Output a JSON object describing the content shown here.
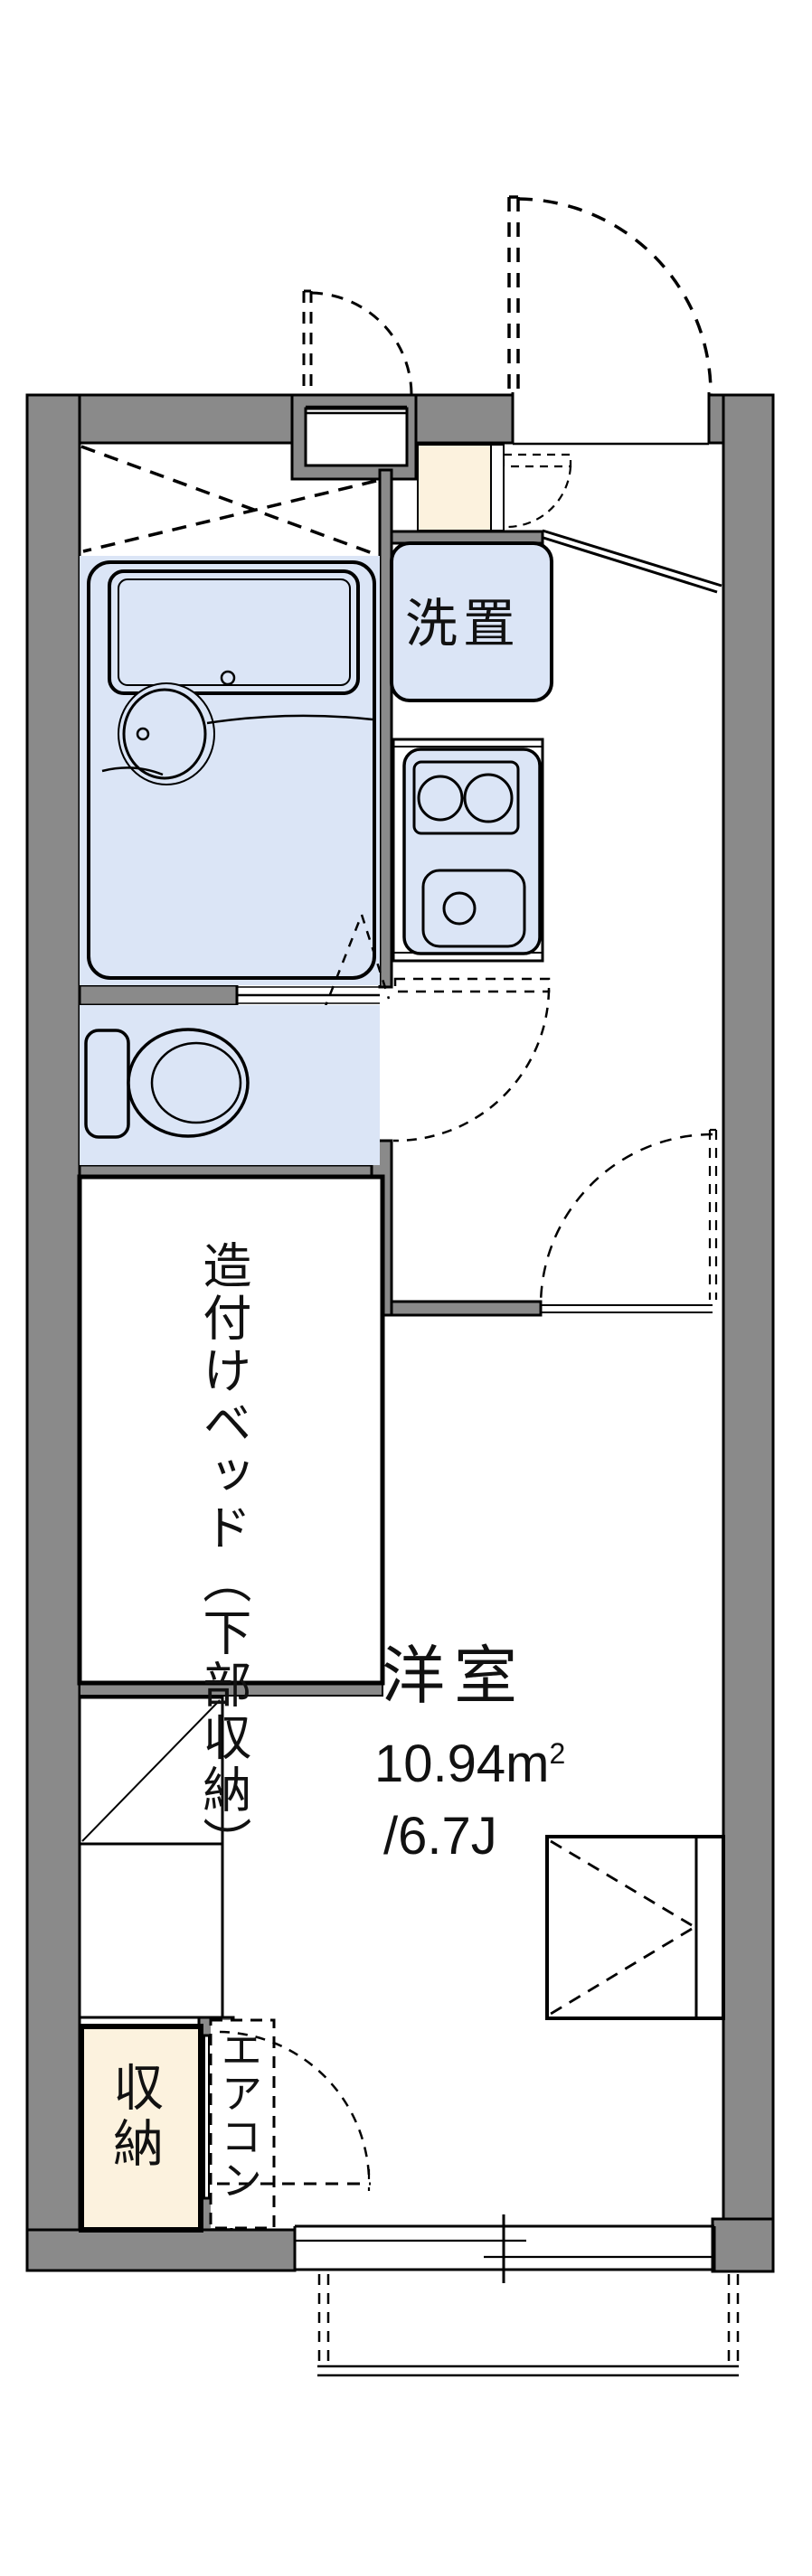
{
  "title": "1K apartment floor plan",
  "colors": {
    "wall": "#8a8a8a",
    "black": "#000000",
    "water": "#dbe5f6",
    "cream": "#fcf2de",
    "white": "#ffffff"
  },
  "labels": {
    "laundry": "洗置",
    "built_in_bed": "造付けベッド（下部収納）",
    "room_name": "洋室",
    "room_area": "10.94m",
    "room_area_sup": "2",
    "room_size": "/6.7J",
    "closet": "収納",
    "aircon": "エアコン"
  },
  "room_values": {
    "western_room_sqm": 10.94,
    "western_room_tatami": 6.7
  }
}
